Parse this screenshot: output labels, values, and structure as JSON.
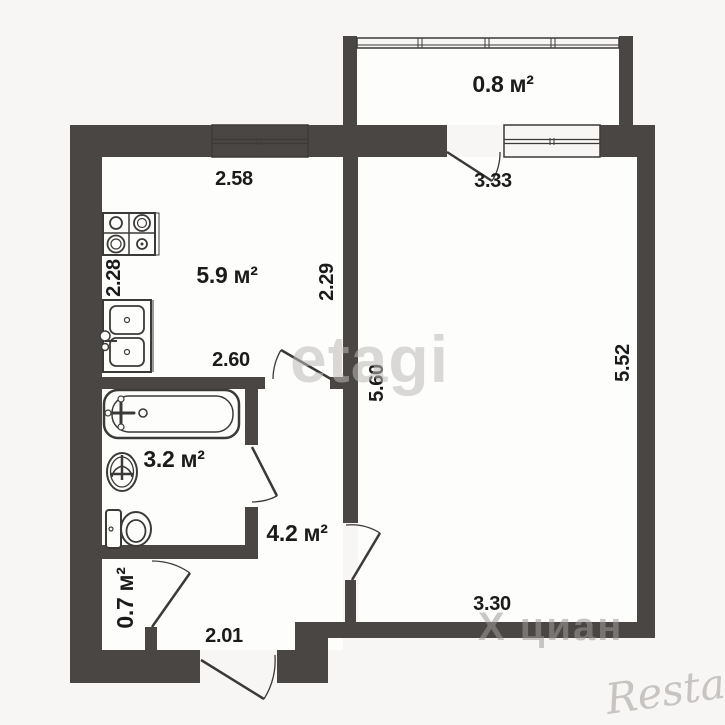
{
  "plan_title": "one-room apartment floor plan",
  "rooms": {
    "kitchen": {
      "area_label": "5.9 м²"
    },
    "balcony": {
      "area_label": "0.8 м²"
    },
    "bathroom": {
      "area_label": "3.2 м²"
    },
    "hallway": {
      "area_label": "4.2 м²"
    },
    "closet": {
      "area_label": "0.7 м²"
    }
  },
  "dimensions": {
    "kitchen_top_width": "2.58",
    "kitchen_left_depth": "2.28",
    "kitchen_right_depth": "2.29",
    "kitchen_bottom_width": "2.60",
    "living_top_width": "3.33",
    "living_left_height": "5.60",
    "living_right_height": "5.52",
    "living_bottom_width": "3.30",
    "hall_bottom_width": "2.01"
  },
  "watermarks": {
    "etagi": "etagi",
    "cian": "Х циан",
    "restate": "Restate"
  },
  "colors": {
    "wall": "#4a4644",
    "background": "#f7f6f4",
    "line": "#3c3a38",
    "text": "#1b1b1b"
  }
}
